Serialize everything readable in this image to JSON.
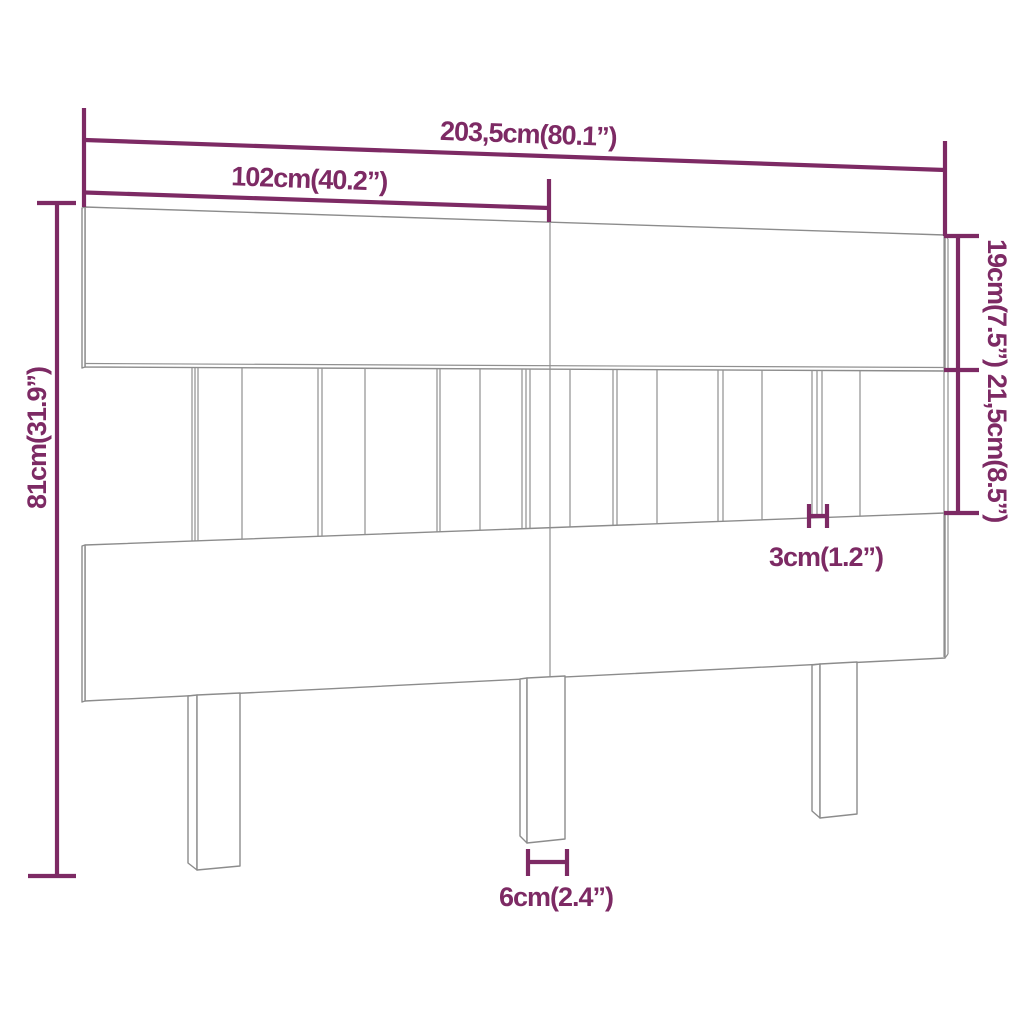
{
  "diagram": {
    "title": "headboard-dimension-diagram",
    "product": "slatted-headboard-with-three-legs",
    "colors": {
      "dimension_accent": "#7d2a64",
      "outline_gray": "#8c8c8c",
      "background": "#ffffff"
    },
    "dimensions": {
      "total_width": "203,5cm(80.1”)",
      "half_width": "102cm(40.2”)",
      "top_board_height": "19cm(7.5”)",
      "slat_section_height": "21,5cm(8.5”)",
      "total_height": "81cm(31.9”)",
      "slat_width": "3cm(1.2”)",
      "leg_width": "6cm(2.4”)"
    }
  }
}
